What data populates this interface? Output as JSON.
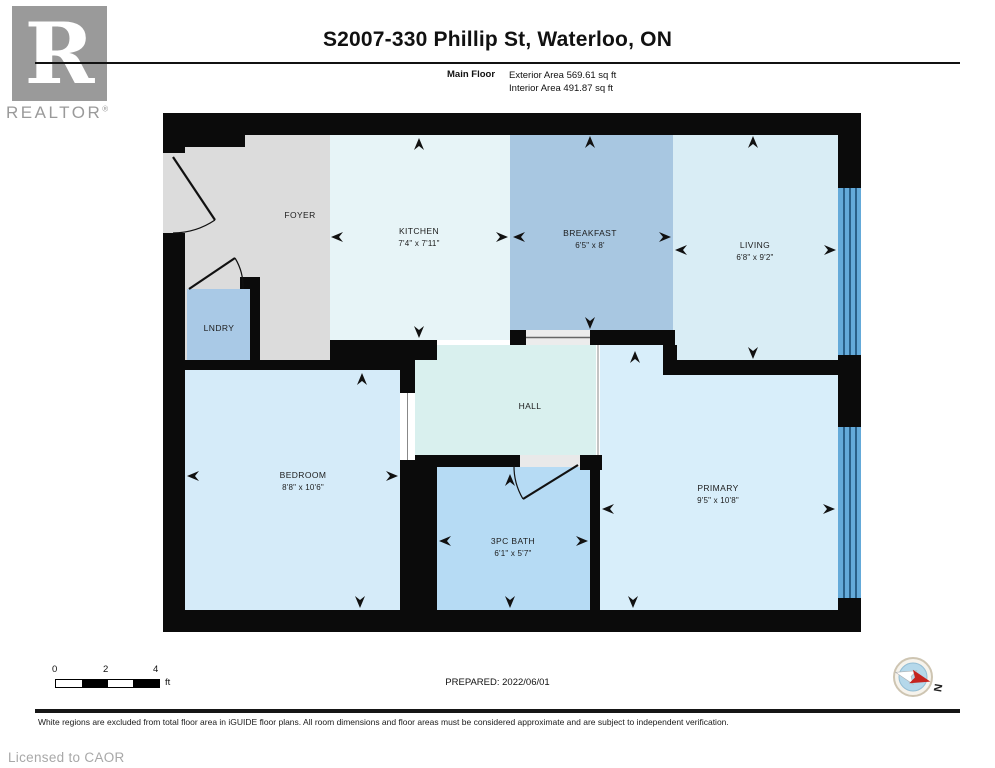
{
  "header": {
    "title": "S2007-330 Phillip St, Waterloo, ON",
    "floor_label": "Main Floor",
    "exterior_area": "Exterior Area 569.61 sq ft",
    "interior_area": "Interior Area 491.87 sq ft"
  },
  "logo": {
    "letter": "R",
    "brand": "REALTOR",
    "registered": "®"
  },
  "rooms": {
    "foyer": {
      "name": "FOYER",
      "dims": "",
      "color": "#dcdcdc"
    },
    "lndry": {
      "name": "LNDRY",
      "dims": "",
      "color": "#a9c9e6"
    },
    "kitchen": {
      "name": "KITCHEN",
      "dims": "7'4\" x 7'11\"",
      "color": "#e7f4f7"
    },
    "breakfast": {
      "name": "BREAKFAST",
      "dims": "6'5\" x 8'",
      "color": "#a8c7e1"
    },
    "living": {
      "name": "LIVING",
      "dims": "6'8\" x 9'2\"",
      "color": "#d9edf5"
    },
    "hall": {
      "name": "HALL",
      "dims": "",
      "color": "#d9f0ee"
    },
    "bedroom": {
      "name": "BEDROOM",
      "dims": "8'8\" x 10'6\"",
      "color": "#d5ebf9"
    },
    "bath": {
      "name": "3PC BATH",
      "dims": "6'1\" x 5'7\"",
      "color": "#b6dbf4"
    },
    "primary": {
      "name": "PRIMARY",
      "dims": "9'5\" x 10'8\"",
      "color": "#d8eefa"
    }
  },
  "colors": {
    "wall": "#0b0b0b",
    "window": "#64aad9",
    "window_line": "#16476d",
    "compass_red": "#c5241f",
    "logo_gray": "#9a9a9a"
  },
  "footer": {
    "scale": {
      "t0": "0",
      "t2": "2",
      "t4": "4",
      "unit": "ft"
    },
    "prepared": "PREPARED: 2022/06/01",
    "compass_n": "N",
    "disclaimer": "White regions are excluded from total floor area in iGUIDE floor plans. All room dimensions and floor areas must be considered approximate and are subject to independent verification.",
    "licensed": "Licensed to CAOR"
  }
}
